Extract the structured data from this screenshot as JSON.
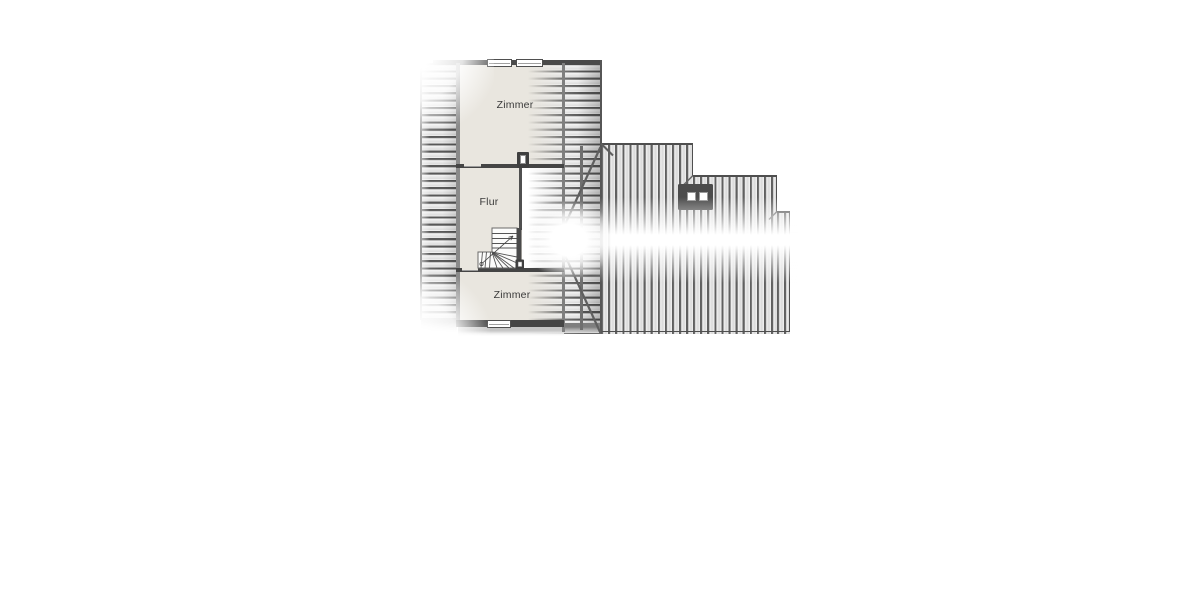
{
  "plan": {
    "type": "attic-floor-plan",
    "rooms": [
      {
        "id": "zimmer-top",
        "label": "Zimmer"
      },
      {
        "id": "flur",
        "label": "Flur"
      },
      {
        "id": "zimmer-bottom",
        "label": "Zimmer"
      }
    ],
    "colors": {
      "background": "#ffffff",
      "room_fill": "#e9e6df",
      "wall_dark": "#454545",
      "hatch_line": "#5a5a5a",
      "roof_edge": "#4f4f4f",
      "chimney_fill": "#464646",
      "ridge_highlight": "#ffffff"
    },
    "elements": {
      "skylight_icon": "roof-skylight-two-panes",
      "chimney_icon": "chimney-shaft",
      "stairs_icon": "quarter-turn-winder-staircase",
      "windows_top_count": 2,
      "windows_bottom_count": 1
    }
  }
}
